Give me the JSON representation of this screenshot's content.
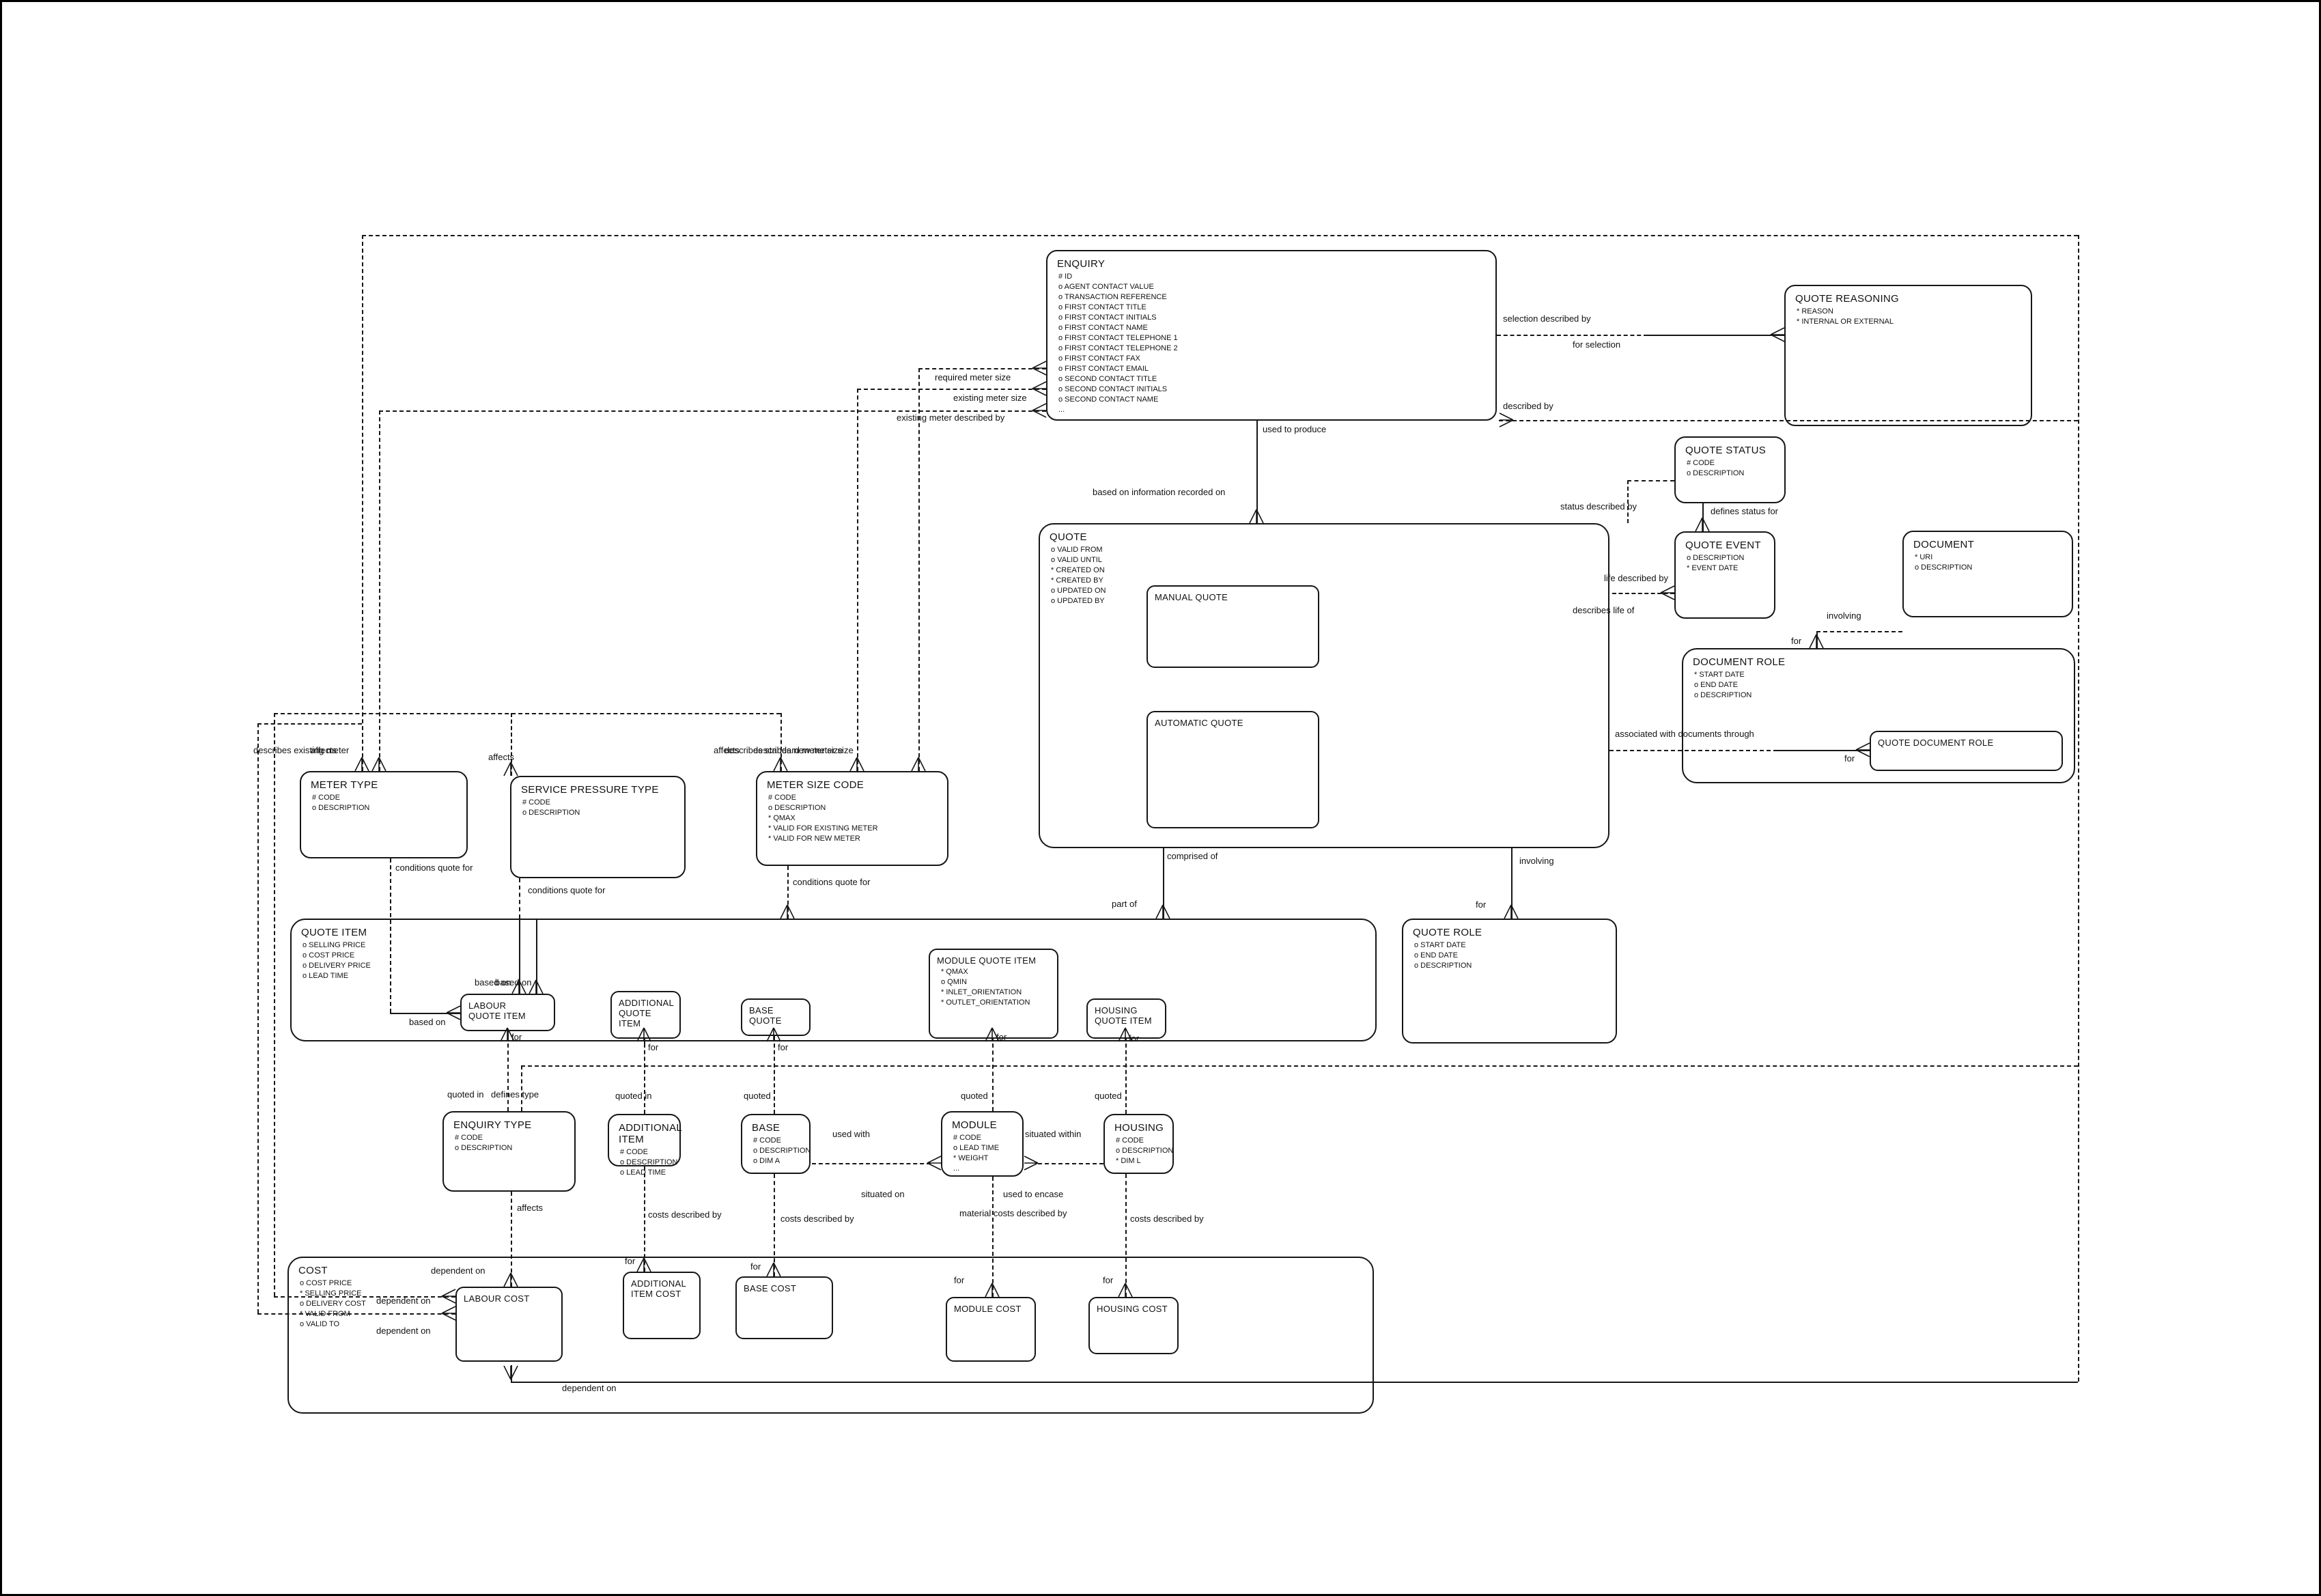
{
  "entities": {
    "enquiry": {
      "title": "ENQUIRY",
      "attrs": [
        "# ID",
        "o AGENT CONTACT VALUE",
        "o TRANSACTION REFERENCE",
        "o FIRST CONTACT TITLE",
        "o FIRST CONTACT INITIALS",
        "o FIRST CONTACT NAME",
        "o FIRST CONTACT TELEPHONE 1",
        "o FIRST CONTACT TELEPHONE 2",
        "o FIRST CONTACT FAX",
        "o FIRST CONTACT EMAIL",
        "o SECOND CONTACT TITLE",
        "o SECOND CONTACT INITIALS",
        "o SECOND CONTACT NAME",
        "..."
      ]
    },
    "quote_reasoning": {
      "title": "QUOTE REASONING",
      "attrs": [
        "* REASON",
        "* INTERNAL OR EXTERNAL"
      ]
    },
    "quote_status": {
      "title": "QUOTE STATUS",
      "attrs": [
        "# CODE",
        "o DESCRIPTION"
      ]
    },
    "quote_event": {
      "title": "QUOTE EVENT",
      "attrs": [
        "o DESCRIPTION",
        "* EVENT DATE"
      ]
    },
    "document": {
      "title": "DOCUMENT",
      "attrs": [
        "* URI",
        "o DESCRIPTION"
      ]
    },
    "quote": {
      "title": "QUOTE",
      "attrs": [
        "o VALID FROM",
        "o VALID UNTIL",
        "* CREATED ON",
        "* CREATED BY",
        "o UPDATED ON",
        "o UPDATED BY"
      ]
    },
    "manual_quote": {
      "title": "MANUAL QUOTE",
      "attrs": []
    },
    "automatic_quote": {
      "title": "AUTOMATIC QUOTE",
      "attrs": []
    },
    "document_role": {
      "title": "DOCUMENT ROLE",
      "attrs": [
        "* START DATE",
        "o END DATE",
        "o DESCRIPTION"
      ]
    },
    "quote_document_role": {
      "title": "QUOTE DOCUMENT ROLE",
      "attrs": []
    },
    "meter_type": {
      "title": "METER TYPE",
      "attrs": [
        "# CODE",
        "o DESCRIPTION"
      ]
    },
    "service_pressure_type": {
      "title": "SERVICE PRESSURE TYPE",
      "attrs": [
        "# CODE",
        "o DESCRIPTION"
      ]
    },
    "meter_size_code": {
      "title": "METER SIZE CODE",
      "attrs": [
        "# CODE",
        "o DESCRIPTION",
        "* QMAX",
        "* VALID FOR EXISTING METER",
        "* VALID FOR NEW METER"
      ]
    },
    "quote_item": {
      "title": "QUOTE ITEM",
      "attrs": [
        "o SELLING PRICE",
        "o COST PRICE",
        "o DELIVERY PRICE",
        "o LEAD TIME"
      ]
    },
    "labour_quote_item": {
      "title": "LABOUR\nQUOTE ITEM",
      "attrs": []
    },
    "additional_quote_item": {
      "title": "ADDITIONAL\nQUOTE\nITEM",
      "attrs": []
    },
    "base_quote": {
      "title": "BASE\nQUOTE",
      "attrs": []
    },
    "module_quote_item": {
      "title": "MODULE QUOTE ITEM",
      "attrs": [
        "* QMAX",
        "o QMIN",
        "* INLET_ORIENTATION",
        "* OUTLET_ORIENTATION"
      ]
    },
    "housing_quote_item": {
      "title": "HOUSING\nQUOTE ITEM",
      "attrs": []
    },
    "quote_role": {
      "title": "QUOTE ROLE",
      "attrs": [
        "o START DATE",
        "o END DATE",
        "o DESCRIPTION"
      ]
    },
    "enquiry_type": {
      "title": "ENQUIRY TYPE",
      "attrs": [
        "# CODE",
        "o DESCRIPTION"
      ]
    },
    "additional_item": {
      "title": "ADDITIONAL\nITEM",
      "attrs": [
        "# CODE",
        "o DESCRIPTION",
        "o LEAD TIME"
      ]
    },
    "base": {
      "title": "BASE",
      "attrs": [
        "# CODE",
        "o DESCRIPTION",
        "o DIM A",
        "..."
      ]
    },
    "module": {
      "title": "MODULE",
      "attrs": [
        "# CODE",
        "o LEAD TIME",
        "* WEIGHT",
        "..."
      ]
    },
    "housing": {
      "title": "HOUSING",
      "attrs": [
        "# CODE",
        "o DESCRIPTION",
        "* DIM L",
        "..."
      ]
    },
    "cost": {
      "title": "COST",
      "attrs": [
        "o COST PRICE",
        "* SELLING PRICE",
        "o DELIVERY COST",
        "* VALID FROM",
        "o VALID TO"
      ]
    },
    "labour_cost": {
      "title": "LABOUR COST",
      "attrs": []
    },
    "additional_item_cost": {
      "title": "ADDITIONAL\nITEM COST",
      "attrs": []
    },
    "base_cost": {
      "title": "BASE COST",
      "attrs": []
    },
    "module_cost": {
      "title": "MODULE COST",
      "attrs": []
    },
    "housing_cost": {
      "title": "HOUSING COST",
      "attrs": []
    }
  },
  "labels": {
    "used_to_produce": "used to produce",
    "based_on_info": "based on information recorded on",
    "selection_described_by": "selection described by",
    "for_selection": "for selection",
    "described_by": "described by",
    "required_meter_size": "required meter size",
    "existing_meter_size": "existing meter size",
    "existing_meter_described_by": "existing meter described by",
    "status_described_by": "status described by",
    "defines_status_for": "defines status for",
    "life_described_by": "life described by",
    "describes_life_of": "describes life of",
    "involving_doc": "involving",
    "for_doc": "for",
    "associated_with": "associated with documents through",
    "for_qdr": "for",
    "comprised_of": "comprised of",
    "part_of": "part of",
    "involving_qr": "involving",
    "for_qr": "for",
    "describes_existing_meter": "describes existing meter",
    "affects_mt": "affects",
    "affects_spt": "affects",
    "affects_msc": "affects",
    "describes_standard_msc": "describes standard meter size",
    "describes_new_msc": "describes new meter size",
    "conditions_1": "conditions quote for",
    "conditions_2": "conditions quote for",
    "conditions_3": "conditions quote for",
    "based_on_1": "based on",
    "based_on_2": "based on",
    "based_on_h": "based on",
    "for_lqi": "for",
    "for_aqi": "for",
    "for_bq": "for",
    "for_mqi": "for",
    "for_hqi": "for",
    "quoted_in_et": "quoted in",
    "defines_type": "defines type",
    "quoted_in_ai": "quoted in",
    "quoted_b": "quoted",
    "quoted_m": "quoted",
    "quoted_h": "quoted",
    "used_with": "used with",
    "situated_on": "situated on",
    "situated_within": "situated within",
    "used_to_encase": "used to encase",
    "affects_et": "affects",
    "costs_described_by_a": "costs described by",
    "costs_described_by_b": "costs described by",
    "material_costs": "material costs described by",
    "costs_described_by_h": "costs described by",
    "dependent_on_top": "dependent on",
    "dependent_on_1": "dependent on",
    "dependent_on_2": "dependent on",
    "dependent_on_bl": "dependent on",
    "for_ac": "for",
    "for_bc": "for",
    "for_mc": "for",
    "for_hc": "for"
  }
}
